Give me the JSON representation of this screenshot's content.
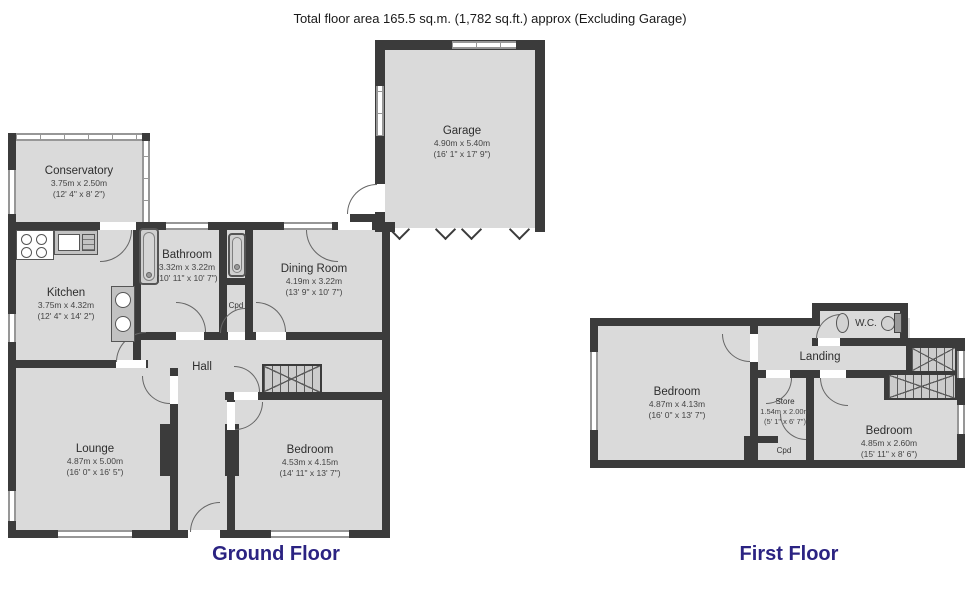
{
  "title": "Total floor area 165.5 sq.m. (1,782 sq.ft.) approx (Excluding Garage)",
  "colors": {
    "wall": "#3b3b3b",
    "room_fill": "#dadada",
    "floor_label": "#2b2382"
  },
  "floors": {
    "ground": {
      "label": "Ground Floor",
      "rooms": {
        "conservatory": {
          "name": "Conservatory",
          "metric": "3.75m x 2.50m",
          "imperial": "(12' 4\" x 8' 2\")"
        },
        "kitchen": {
          "name": "Kitchen",
          "metric": "3.75m x 4.32m",
          "imperial": "(12' 4\" x 14' 2\")"
        },
        "bathroom": {
          "name": "Bathroom",
          "metric": "3.32m x 3.22m",
          "imperial": "(10' 11\" x 10' 7\")"
        },
        "dining": {
          "name": "Dining Room",
          "metric": "4.19m x 3.22m",
          "imperial": "(13' 9\" x 10' 7\")"
        },
        "garage": {
          "name": "Garage",
          "metric": "4.90m x 5.40m",
          "imperial": "(16' 1\" x 17' 9\")"
        },
        "hall": {
          "name": "Hall"
        },
        "cpd": {
          "name": "Cpd"
        },
        "lounge": {
          "name": "Lounge",
          "metric": "4.87m x 5.00m",
          "imperial": "(16' 0\" x 16' 5\")"
        },
        "bedroom": {
          "name": "Bedroom",
          "metric": "4.53m x 4.15m",
          "imperial": "(14' 11\" x 13' 7\")"
        }
      }
    },
    "first": {
      "label": "First Floor",
      "rooms": {
        "bedroom1": {
          "name": "Bedroom",
          "metric": "4.87m x 4.13m",
          "imperial": "(16' 0\" x 13' 7\")"
        },
        "landing": {
          "name": "Landing"
        },
        "wc": {
          "name": "W.C."
        },
        "store": {
          "name": "Store",
          "metric": "1.54m x 2.00m",
          "imperial": "(5' 1\" x 6' 7\")"
        },
        "cpd": {
          "name": "Cpd"
        },
        "bedroom2": {
          "name": "Bedroom",
          "metric": "4.85m x 2.60m",
          "imperial": "(15' 11\" x 8' 6\")"
        }
      }
    }
  }
}
